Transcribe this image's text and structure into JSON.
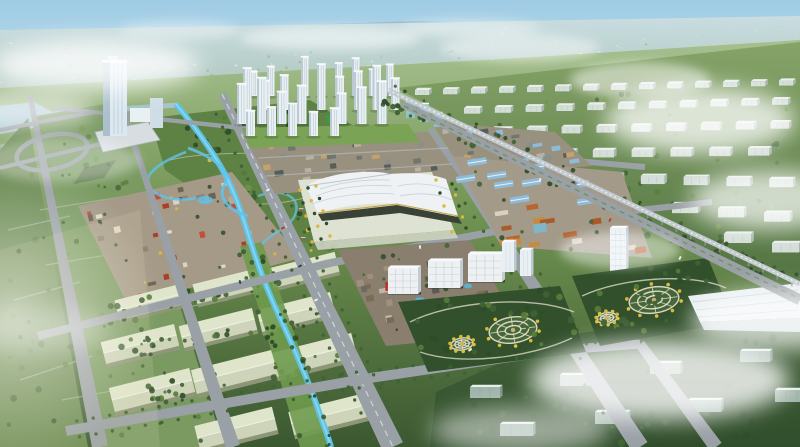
{
  "image": {
    "kind": "aerial architectural rendering",
    "subject": "Bird's-eye master-plan rendering of a planned urban district: landmark office tower and winding canal park on the left, white high-rise residential cluster and wavy-roofed exhibition hall in the center, orange and blue-roofed trade districts, circular mandala parks, warehouse blocks, an elevated railway, and rows of pale slab buildings receding into haze on the right",
    "visible_text": "none"
  },
  "scene_elements": [
    {
      "name": "sky-layer",
      "desc": "pale blue sky with hazy horizon"
    },
    {
      "name": "horizon-layer",
      "desc": "distant blue ridge and hazy urban sprawl"
    },
    {
      "name": "ground-layer",
      "desc": "green ground plane in oblique perspective"
    },
    {
      "name": "water-layer",
      "desc": "hazy lake and river at far left"
    },
    {
      "name": "west-fields",
      "desc": "gridded green field blocks with loop interchange"
    },
    {
      "name": "west-park",
      "desc": "landscaped park with meandering bright canal and villas"
    },
    {
      "name": "village-district",
      "desc": "colorful low-rise mixed-use village"
    },
    {
      "name": "warehouse-district",
      "desc": "rows of pale gable-roof warehouses among tree lines"
    },
    {
      "name": "canal",
      "desc": "bright blue canal with green banks"
    },
    {
      "name": "road-network",
      "desc": "fan of gray avenues with street trees"
    },
    {
      "name": "north-lowrise-district",
      "desc": "dense grid of small dark- and tan-roofed blocks"
    },
    {
      "name": "east-shops-district",
      "desc": "blue-roofed sheds and terracotta commercial rows"
    },
    {
      "name": "oldstreet-district",
      "desc": "brown-roofed traditional street blocks with pools"
    },
    {
      "name": "highrise-cluster",
      "desc": "cluster of white residential towers"
    },
    {
      "name": "landmark-tower",
      "desc": "tall white-blue glass landmark tower with podium"
    },
    {
      "name": "expo-center",
      "desc": "white wavy-roof exhibition hall with formal tree grid"
    },
    {
      "name": "office-blocks",
      "desc": "white perforated-facade office boxes"
    },
    {
      "name": "hotel-tower",
      "desc": "white slab hotel tower"
    },
    {
      "name": "mandala-parks",
      "desc": "two dark-green parks with circular ring gardens and yellow trees"
    },
    {
      "name": "east-slab-district",
      "desc": "diagonal rows of pale slab buildings on green"
    },
    {
      "name": "south-slab-district",
      "desc": "dark green zone with slab buildings under mist"
    },
    {
      "name": "industrial-hall",
      "desc": "long white industrial hall lower right"
    },
    {
      "name": "railway-line",
      "desc": "elevated railway viaduct with tree belt and parallel avenue"
    },
    {
      "name": "vehicles",
      "desc": "tiny cars on the avenues"
    },
    {
      "name": "mist-layer",
      "desc": "soft white clouds drifting over the scene"
    },
    {
      "name": "light-glow",
      "desc": "warm sunlight glow at lower left"
    }
  ],
  "palette": {
    "sky_top": "#9ecbe3",
    "sky_mid": "#b6d9ea",
    "sky_horizon": "#d6e8ee",
    "ridge": "#87a9c0",
    "hills_left": "#8fafc6",
    "haze_top": "#c9dde2",
    "haze_bottom": "#aec6ba",
    "ground_far": "#a6c08f",
    "ground_mid": "#6f9150",
    "ground_near": "#3b5831",
    "field_dark": "#6b8a52",
    "field_light": "#7a9a62",
    "grid_line": "#c2cab8",
    "park_green": "#5d8244",
    "park_dark": "#31502b",
    "lawn": "#7aa355",
    "sports_field": "#3e9a44",
    "road": "#9aa1a6",
    "road_light": "#b9bfc3",
    "road_dash": "#dde1e4",
    "canal": "#5fc3ea",
    "canal_light": "#8adcf4",
    "water_haze": "#a9c9d6",
    "bank_green": "#6f9a4e",
    "building_white": "#e9f0f4",
    "building_side": "#bccad4",
    "building_top": "#f7fafc",
    "window_line": "#9fb4c2",
    "glass_teal": "#8fc3c6",
    "tower_face": "#dce8f0",
    "tower_side": "#a9bfcc",
    "podium": "#d7dde0",
    "expo_plinth": "#dde2d2",
    "expo_roof": "#eef2f4",
    "expo_roof_line": "#b9c2c8",
    "expo_glass": "#3a4238",
    "gold_trim": "#c8a23c",
    "forecourt": "#cfd4c4",
    "lowrise_base": "#98917f",
    "roof_dark": "#575d59",
    "roof_slate": "#6f7570",
    "roof_tan": "#c8a06a",
    "village_base": "#a59a88",
    "roof_red": "#a8402c",
    "roof_red2": "#c05038",
    "wall_cream": "#d9d2c4",
    "wall_gray": "#8d8274",
    "villa_roof": "#7a6b56",
    "villa_wall": "#ded5c0",
    "shops_base": "#a39a8a",
    "roof_blue": "#8ebcd8",
    "roof_terracotta": "#b5672f",
    "roof_amber": "#c9893f",
    "oldstreet_base": "#8a7f6e",
    "roof_brown": "#7b6b54",
    "pool_blue": "#58b7d8",
    "warehouse_roof": "#cdd4b9",
    "warehouse_roof_light": "#dfe5cb",
    "warehouse_side": "#8e9678",
    "warehouse_ridge": "#eef2e2",
    "office_white": "#eef1f3",
    "office_grid": "#b9c2c8",
    "office_side": "#c3ccd2",
    "office_base": "#30363a",
    "accent_red": "#c03028",
    "slab_face": "#d4ded8",
    "slab_top": "#e8eeea",
    "slab_side": "#a5b5ac",
    "slab_dark": "#9fb4a9",
    "slab_dark_side": "#7e948a",
    "rail_deck": "#c4cbd0",
    "rail_pier": "#8e979c",
    "rail_tie": "#f2f5f7",
    "median_green": "#6f8f56",
    "tree_dark": "#2f4c28",
    "tree_mid": "#3f6134",
    "tree_green": "#557b3a",
    "tree_light": "#6f9447",
    "tree_yellow": "#d8b93c",
    "tree_gold": "#e0c040",
    "ring_path": "#e8e4d0",
    "path_light": "#d8d8c6",
    "ring_center": "#c9b26a",
    "zone_east_top": "#86a468",
    "zone_east_bot": "#4f7040",
    "zone_south_top": "#47663c",
    "zone_south_bot": "#314e2c",
    "hall_white": "#e8eef0",
    "hall_side": "#c9d4d8",
    "mist": "#ffffff",
    "glow_warm": "#f6edc8",
    "shadow": "#22301c",
    "car_white": "#f2f4f6",
    "car_red": "#c03028",
    "car_dark": "#2a3a4a"
  }
}
